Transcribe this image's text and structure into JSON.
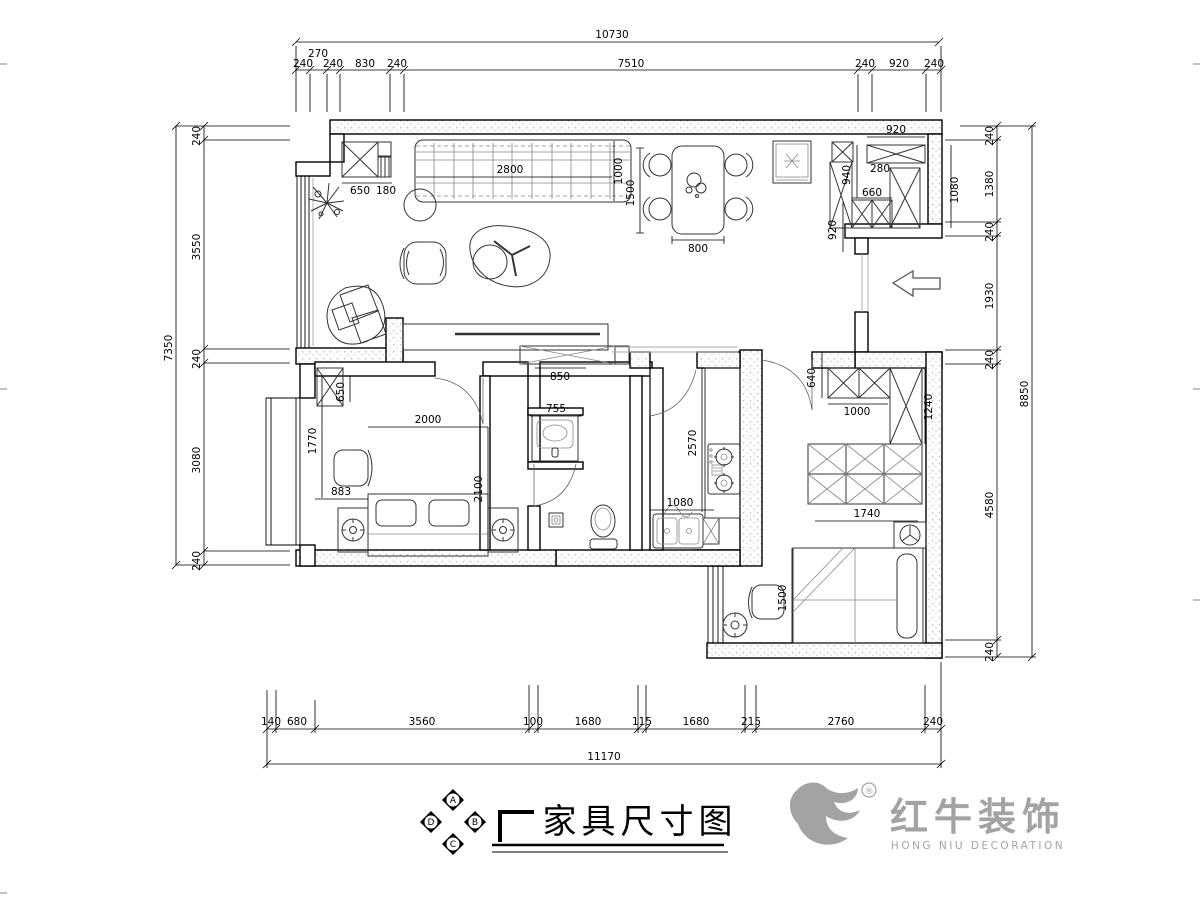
{
  "sheet": {
    "background": "#ffffff",
    "line_color": "#000000",
    "logo_color": "#a3a3a3"
  },
  "title_block": {
    "title": "家具尺寸图",
    "compass": {
      "top": "A",
      "right": "B",
      "bottom": "C",
      "left": "D"
    }
  },
  "logo": {
    "brand": "红牛装饰",
    "subtitle": "HONG NIU DECORATION",
    "registered": "®"
  },
  "dims": {
    "top_total": "10730",
    "top": [
      "240",
      "270",
      "240",
      "830",
      "240",
      "7510",
      "240",
      "920",
      "240"
    ],
    "left_total": "7350",
    "left": [
      "240",
      "3550",
      "240",
      "3080",
      "240"
    ],
    "right_total": "8850",
    "right": [
      "240",
      "1380",
      "240",
      "1930",
      "240",
      "4580",
      "240"
    ],
    "bottom_total": "11170",
    "bottom": [
      "140",
      "680",
      "3560",
      "100",
      "1680",
      "115",
      "1680",
      "215",
      "2760",
      "240"
    ],
    "interior": {
      "hall_closet": "650",
      "hall_closet2": "180",
      "sofa_w": "2800",
      "sofa_d": "1000",
      "dining_l": "1500",
      "dining_w": "800",
      "entry_wardrobe": "920",
      "entry_depth": "940",
      "entry_gap": "280",
      "entry_shoe": "660",
      "entry_side": "920",
      "entry_closet_w": "1080",
      "tv_side": "850",
      "vanity": "755",
      "b1_closet": "650",
      "b1_depth": "1770",
      "b1_bed_w": "2000",
      "b1_bed_l": "2100",
      "b1_side": "883",
      "kt_counter": "2570",
      "kt_sink": "1080",
      "b2_wr_d": "640",
      "b2_wr_w": "1000",
      "b2_closet": "1240",
      "b2_wr2": "1740",
      "b2_bed": "1500"
    }
  }
}
